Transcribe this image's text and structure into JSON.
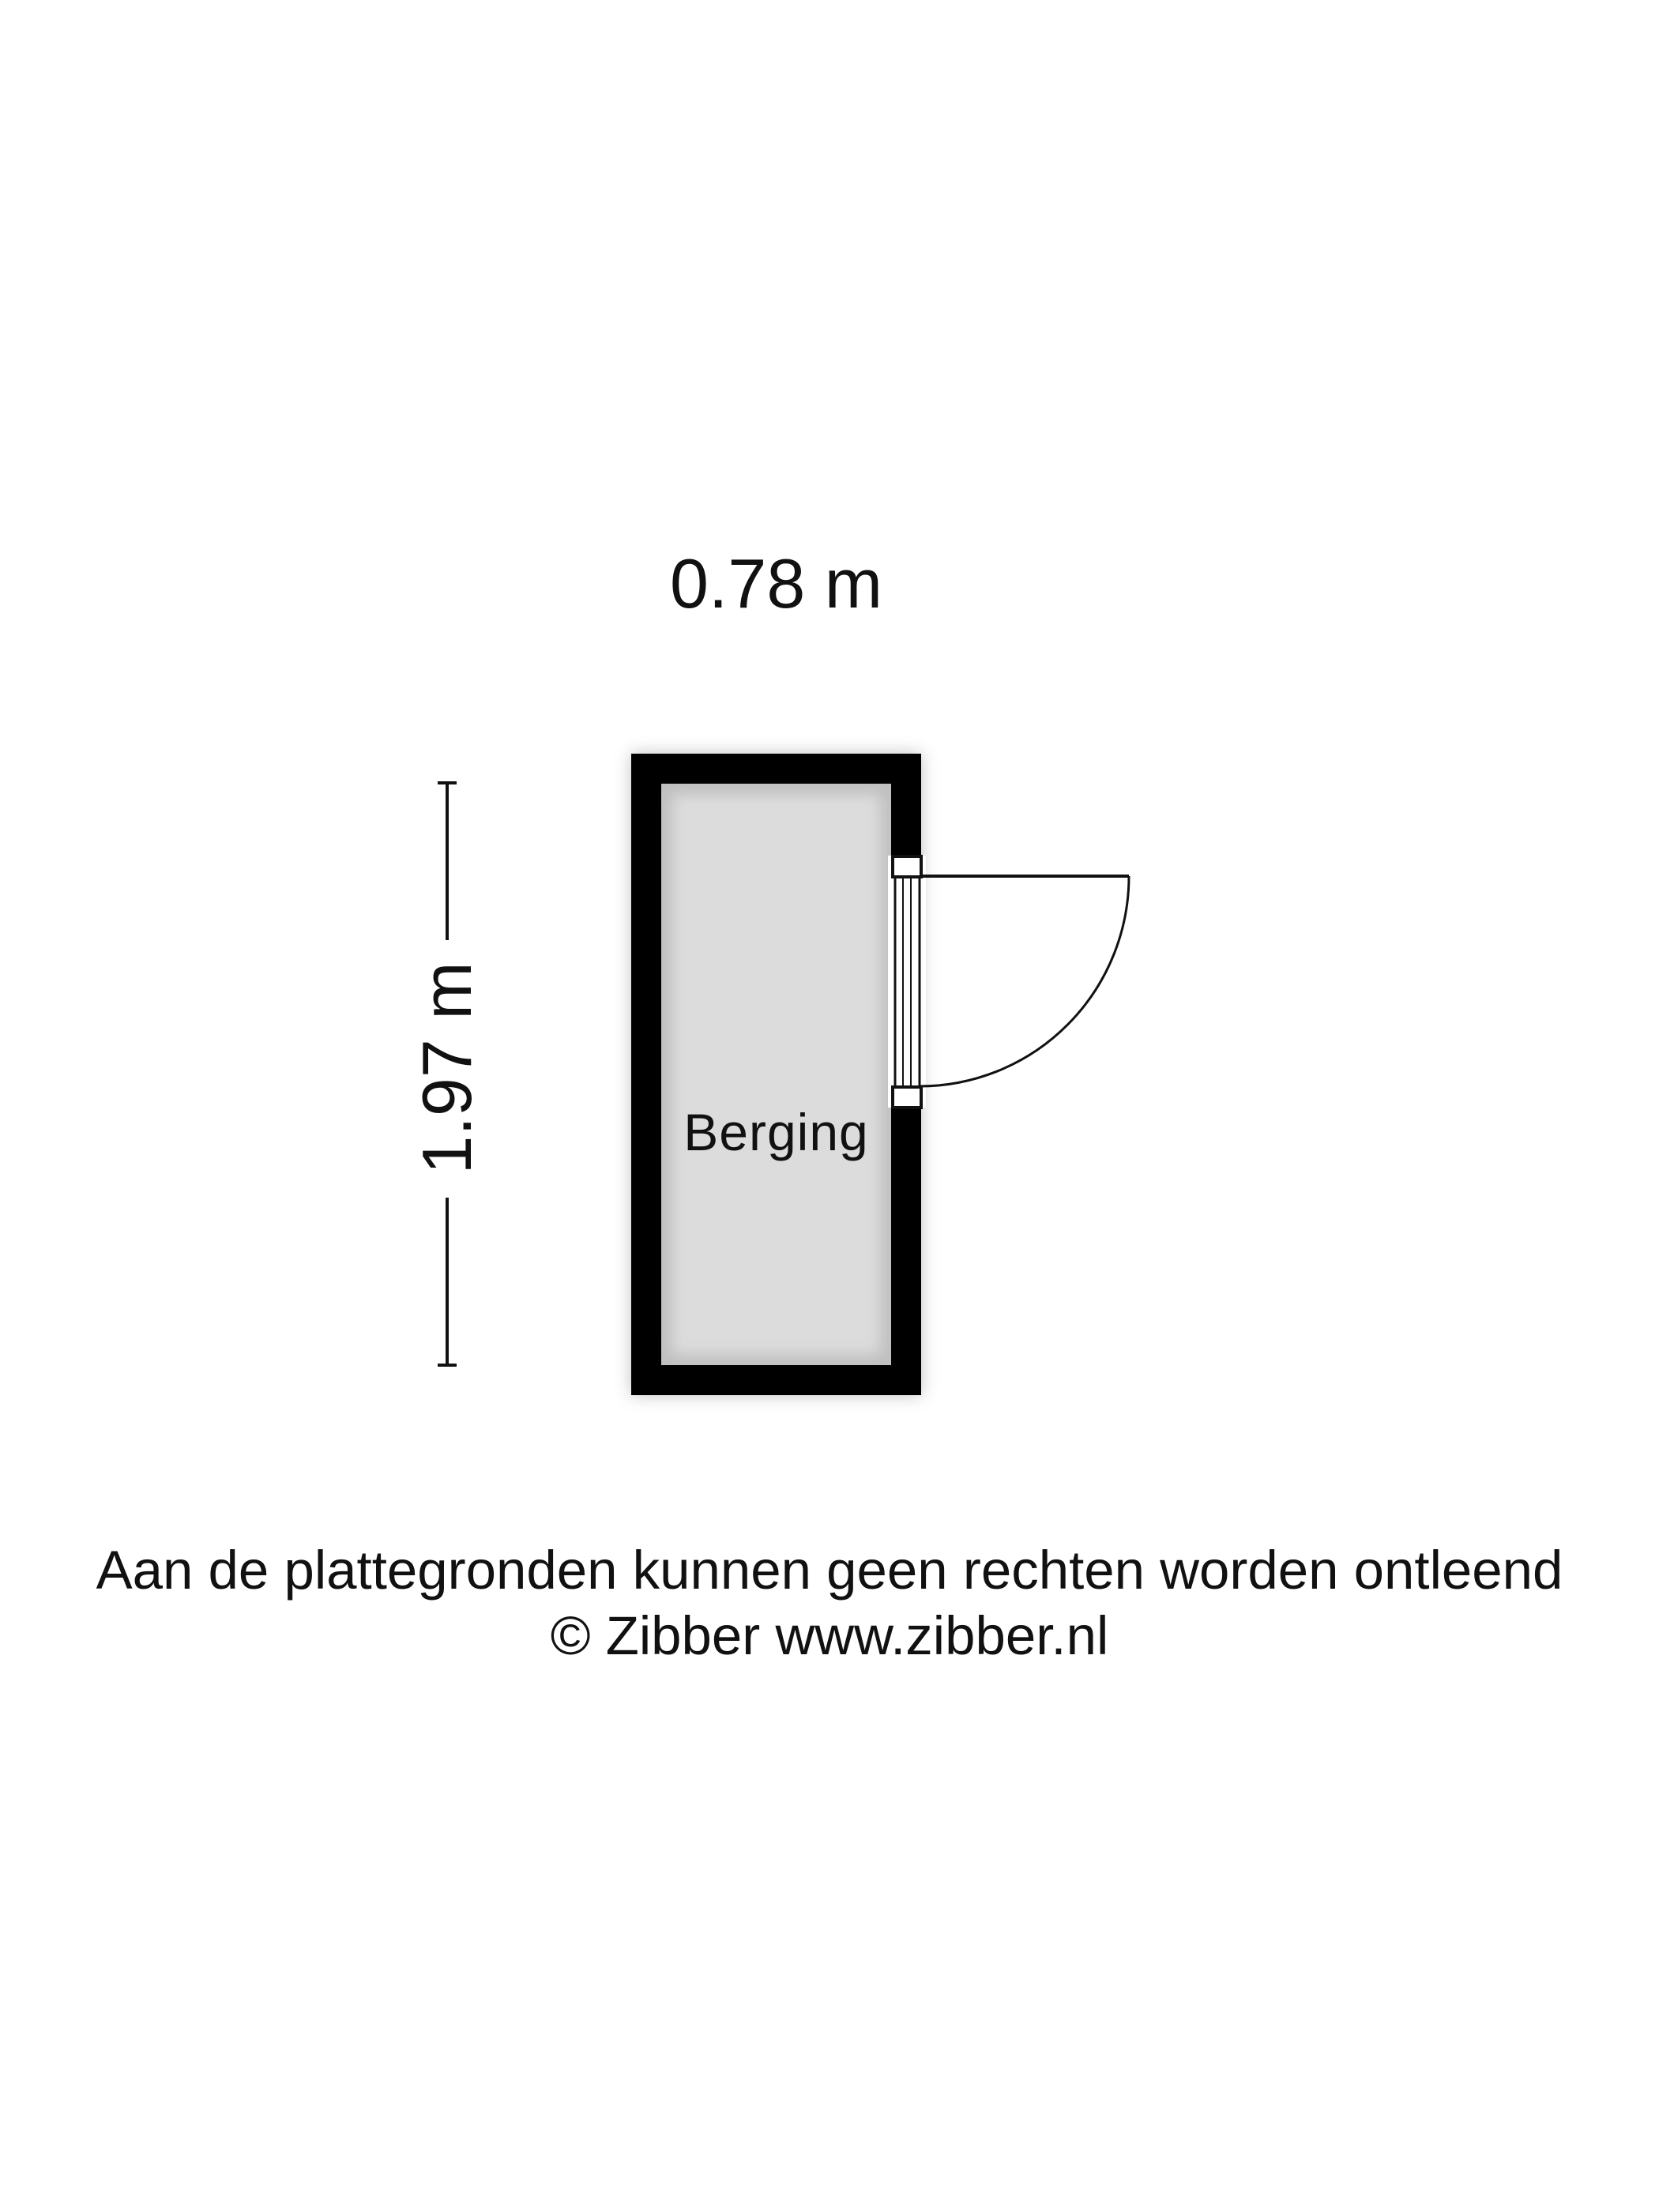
{
  "plan": {
    "room": {
      "label": "Berging",
      "width_label": "0.78 m",
      "height_label": "1.97 m"
    },
    "features": [
      "outer-wall",
      "door-swing-right",
      "vertical-dimension-line"
    ]
  },
  "footer": {
    "disclaimer": "Aan de plattegronden kunnen geen rechten worden ontleend",
    "copyright": "© Zibber www.zibber.nl"
  },
  "colors": {
    "wall": "#000000",
    "floor": "#dcdcdc",
    "line": "#111111",
    "shadow": "#9a9a9a",
    "background": "#ffffff",
    "text": "#111111"
  }
}
